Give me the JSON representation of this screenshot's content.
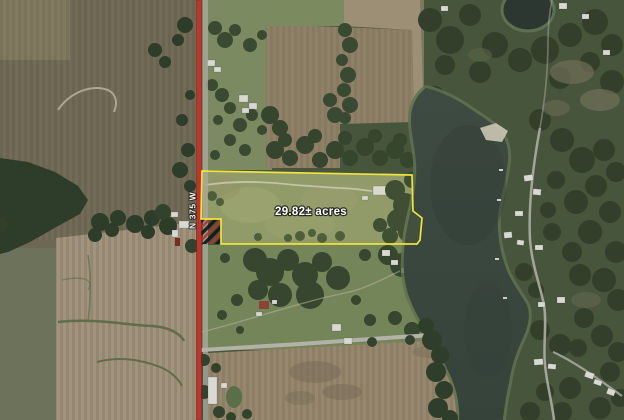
{
  "map": {
    "type": "satellite-aerial-listing-map",
    "labels": {
      "acreage": "29.82± acres",
      "road": "N 375 W"
    },
    "annotations": {
      "parcel_outline_color": "#f2e33d",
      "road_line_color": "#c0342b",
      "hatch_black": "#141414",
      "hatch_red": "#b5332b",
      "label_text_color": "#ffffff"
    },
    "terrain_colors": {
      "water": "#3b4840",
      "marsh_edge": "#5e7250",
      "forest": "#2f3e2a",
      "plowed_field": "#9d8f77",
      "green_field": "#74855a",
      "pavement": "#b3b2a8"
    }
  }
}
